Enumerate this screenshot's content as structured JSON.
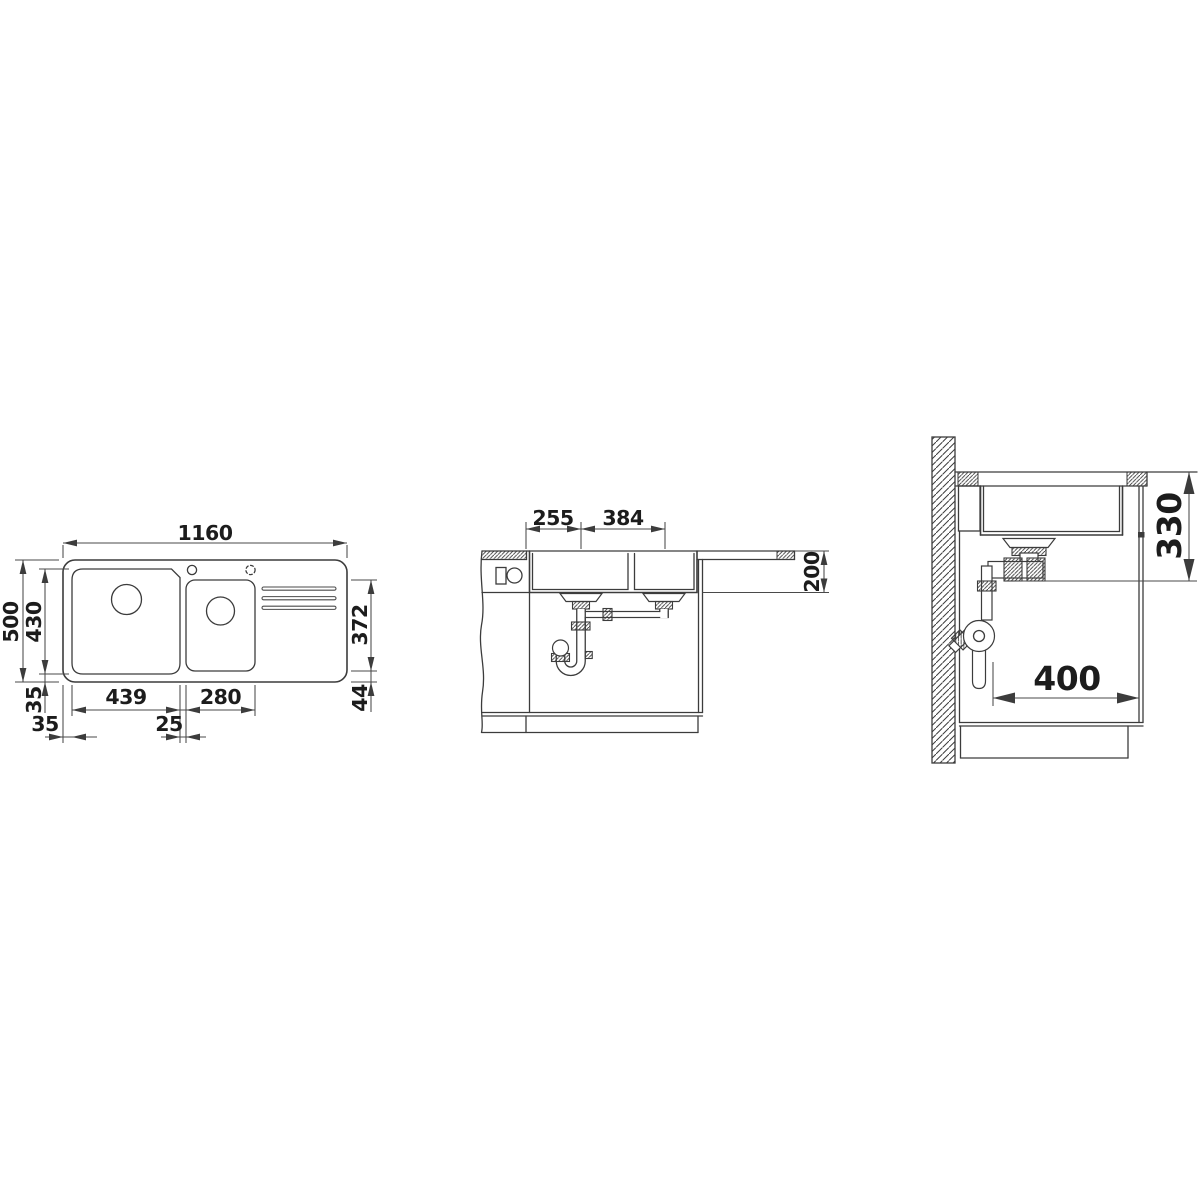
{
  "drawing": {
    "stroke_color": "#3c3c3c",
    "text_color": "#1c1c1c",
    "background_color": "#ffffff",
    "views": {
      "top": {
        "dims": {
          "overall_width": "1160",
          "overall_depth": "500",
          "bowl_depth": "430",
          "rear_inset": "35",
          "main_bowl_width": "439",
          "bowl_gap": "25",
          "half_bowl_width": "280",
          "side_inset": "35",
          "half_bowl_depth": "372",
          "half_bowl_inset": "44"
        }
      },
      "front": {
        "dims": {
          "drain_offset": "255",
          "drain_spacing": "384",
          "bowl_depth": "200"
        }
      },
      "side": {
        "dims": {
          "installation_depth": "330",
          "cabinet_clearance": "400"
        }
      }
    }
  }
}
